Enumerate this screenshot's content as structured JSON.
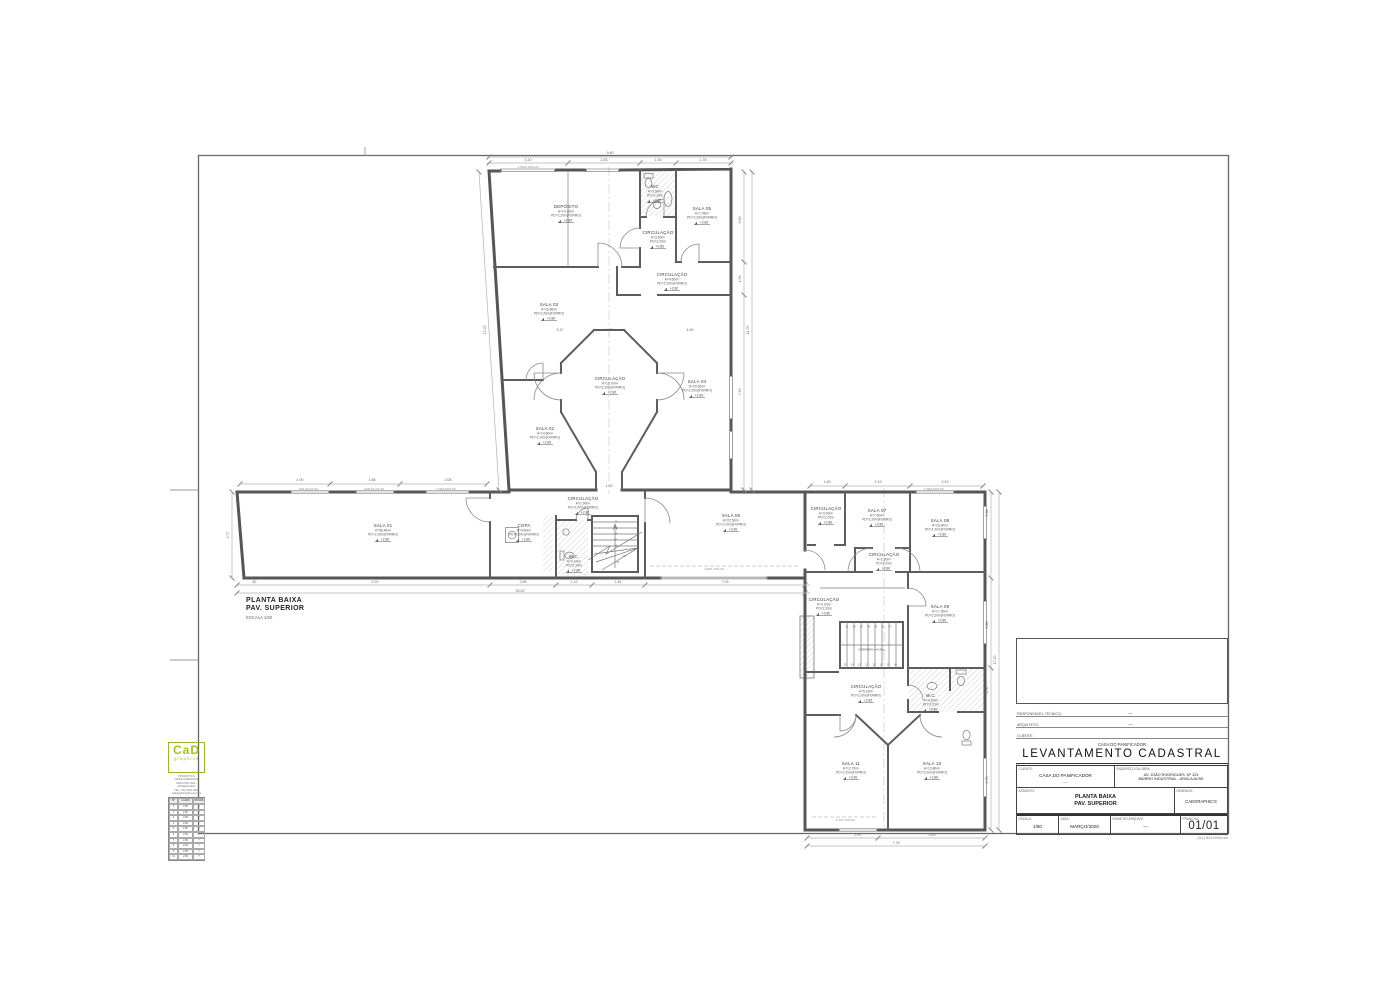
{
  "sheet": {
    "header": {
      "project_small": "CASA DO PANIFICADOR",
      "title": "LEVANTAMENTO  CADASTRAL"
    },
    "signatures": [
      {
        "label": "RESPONSÁVEL TÉCNICO:",
        "value": "—"
      },
      {
        "label": "ARQUITETO:",
        "value": "—"
      },
      {
        "label": "CLIENTE:",
        "value": ""
      }
    ],
    "info": {
      "cliente_label": "CLIENTE:",
      "cliente_value": "CASA DO PANIFICADOR",
      "cliente_value2": "—",
      "endereco_label": "ENDEREÇO DA OBRA:",
      "endereco_line1": "AV. JOÃO RODRIGUES, Nº 123",
      "endereco_line2": "BAIRRO INDUSTRIAL - ARACAJU/SE",
      "assunto_label": "ASSUNTO:",
      "assunto_line1": "PLANTA BAIXA",
      "assunto_line2": "PAV. SUPERIOR",
      "desenho_label": "DESENHO:",
      "desenho_value": "CADGRAPHIC'S",
      "escala_label": "ESCALA:",
      "escala_value": "1/50",
      "data_label": "DATA:",
      "data_value": "MARÇO/2020",
      "arquivo_label": "NOME DO ARQUIVO:",
      "arquivo_value": "—",
      "prancha_label": "PRANCHA:",
      "prancha_value": "01/01"
    },
    "paper_size": "(A1) 841x594mm"
  },
  "logo": {
    "line1": "CaD",
    "line2": "graphics",
    "contact": [
      "PROJETOS E DETALHAMENTOS",
      "ARQUITETURA - ENGENHARIA",
      "TEL: (79) 0000-0000",
      "cadgraphics@email.com"
    ]
  },
  "margin_table": {
    "headers": [
      "Nº",
      "LAJES",
      "PESOS"
    ],
    "rows": [
      [
        "1",
        "2,80",
        "7"
      ],
      [
        "2",
        "2,80",
        "7"
      ],
      [
        "3",
        "2,80",
        "7"
      ],
      [
        "4",
        "2,80",
        "7"
      ],
      [
        "5",
        "2,80",
        "7"
      ],
      [
        "6",
        "2,80",
        "7"
      ],
      [
        "7",
        "2,80",
        "7"
      ],
      [
        "8",
        "2,80",
        "7"
      ],
      [
        "9",
        "2,80",
        "7"
      ],
      [
        "10",
        "2,80",
        "7"
      ]
    ]
  },
  "plan_title": {
    "line1": "PLANTA BAIXA",
    "line2": "PAV. SUPERIOR",
    "scale": "ESCALA 1/50"
  },
  "plan": {
    "rooms": [
      {
        "name": "DEPÓSITO",
        "area": "A=14.10m²",
        "pd": "PD=2.20m(FORRO)",
        "level": "+2.80",
        "x": 566,
        "y": 208
      },
      {
        "name": "WC",
        "area": "A=3.30m²",
        "pd": "PD=2.20m",
        "level": "+2.80",
        "x": 655,
        "y": 188
      },
      {
        "name": "SALA 05",
        "area": "A=7.05m²",
        "pd": "PD=2.20m(FORRO)",
        "level": "+2.80",
        "x": 702,
        "y": 210
      },
      {
        "name": "CIRCULAÇÃO",
        "area": "A=3.60m²",
        "pd": "PD=2.20m",
        "level": "+2.80",
        "x": 658,
        "y": 234
      },
      {
        "name": "CIRCULAÇÃO",
        "area": "A=4.60m²",
        "pd": "PD=2.20m(FORRO)",
        "level": "+2.80",
        "x": 672,
        "y": 276
      },
      {
        "name": "SALA 03",
        "area": "A=16.80m²",
        "pd": "PD=2.20m(FORRO)",
        "level": "+2.80",
        "x": 549,
        "y": 306
      },
      {
        "name": "SALA 02",
        "area": "A=14.60m²",
        "pd": "PD=2.20m(FORRO)",
        "level": "+2.80",
        "x": 545,
        "y": 430
      },
      {
        "name": "CIRCULAÇÃO",
        "area": "A=10.70m²",
        "pd": "PD=2.20m(FORRO)",
        "level": "+2.80",
        "x": 610,
        "y": 380
      },
      {
        "name": "SALA 04",
        "area": "A=20.60m²",
        "pd": "PD=2.20m(FORRO)",
        "level": "+2.80",
        "x": 697,
        "y": 383
      },
      {
        "name": "SALA 01",
        "area": "A=56.40m²",
        "pd": "PD=2.20m(FORRO)",
        "level": "+2.80",
        "x": 383,
        "y": 527
      },
      {
        "name": "COPA",
        "area": "A=4.60m²",
        "pd": "PD=2.20m(FORRO)",
        "level": "+2.80",
        "x": 524,
        "y": 527
      },
      {
        "name": "W.C.",
        "area": "A=3.10m²",
        "pd": "PD=2.20m",
        "level": "+2.80",
        "x": 574,
        "y": 558
      },
      {
        "name": "CIRCULAÇÃO",
        "area": "A=2.90m²",
        "pd": "PD=2.20m(FORRO)",
        "level": "+2.80",
        "x": 583,
        "y": 500
      },
      {
        "name": "SALA 06",
        "area": "A=22.50m²",
        "pd": "PD=2.20m(FORRO)",
        "level": "+2.80",
        "x": 731,
        "y": 517
      },
      {
        "name": "CIRCULAÇÃO",
        "area": "A=3.00m²",
        "pd": "PD=2.20m",
        "level": "+2.80",
        "x": 826,
        "y": 510
      },
      {
        "name": "SALA 07",
        "area": "A=7.50m²",
        "pd": "PD=2.20m(FORRO)",
        "level": "+2.80",
        "x": 877,
        "y": 512
      },
      {
        "name": "SALA 08",
        "area": "A=16.60m²",
        "pd": "PD=2.20m(FORRO)",
        "level": "+2.80",
        "x": 940,
        "y": 522
      },
      {
        "name": "CIRCULAÇÃO",
        "area": "A=2.80m²",
        "pd": "PD=2.20m",
        "level": "+2.80",
        "x": 884,
        "y": 556
      },
      {
        "name": "CIRCULAÇÃO",
        "area": "A=4.10m²",
        "pd": "PD=2.20m",
        "level": "+2.80",
        "x": 824,
        "y": 601
      },
      {
        "name": "SALA 09",
        "area": "A=17.30m²",
        "pd": "PD=2.20m(FORRO)",
        "level": "+2.80",
        "x": 940,
        "y": 608
      },
      {
        "name": "CIRCULAÇÃO",
        "area": "A=5.10m²",
        "pd": "PD=2.20m(FORRO)",
        "level": "+2.80",
        "x": 866,
        "y": 688
      },
      {
        "name": "W.C.",
        "area": "A=4.20m²",
        "pd": "PD=2.20m",
        "level": "+2.80",
        "x": 931,
        "y": 697
      },
      {
        "name": "SALA 11",
        "area": "A=12.70m²",
        "pd": "PD=2.20m(FORRO)",
        "level": "+2.80",
        "x": 851,
        "y": 765
      },
      {
        "name": "SALA 10",
        "area": "A=13.80m²",
        "pd": "PD=2.20m(FORRO)",
        "level": "+2.80",
        "x": 932,
        "y": 765
      }
    ],
    "dimensions": [
      {
        "t": "9.80",
        "x": 610,
        "y": 154
      },
      {
        "t": "3.20",
        "x": 528,
        "y": 161
      },
      {
        "t": "2.45",
        "x": 604,
        "y": 161
      },
      {
        "t": "1.30",
        "x": 658,
        "y": 161
      },
      {
        "t": "1.78",
        "x": 703,
        "y": 161
      },
      {
        "t": "3.60",
        "x": 741,
        "y": 220,
        "r": -90
      },
      {
        "t": "1.35",
        "x": 741,
        "y": 279,
        "r": -90
      },
      {
        "t": "7.45",
        "x": 741,
        "y": 392,
        "r": -90
      },
      {
        "t": "11.70",
        "x": 749,
        "y": 330,
        "r": -90
      },
      {
        "t": "12.25",
        "x": 486,
        "y": 330,
        "r": -86
      },
      {
        "t": "3.77",
        "x": 229,
        "y": 535,
        "r": -90
      },
      {
        "t": "4.90",
        "x": 300,
        "y": 481
      },
      {
        "t": "1.88",
        "x": 372,
        "y": 481
      },
      {
        "t": "2.05",
        "x": 448,
        "y": 481
      },
      {
        "t": "1.45",
        "x": 827,
        "y": 483
      },
      {
        "t": "2.15",
        "x": 878,
        "y": 483
      },
      {
        "t": "2.43",
        "x": 945,
        "y": 483
      },
      {
        "t": ".82",
        "x": 254,
        "y": 583
      },
      {
        "t": "9.22",
        "x": 375,
        "y": 583
      },
      {
        "t": "2.69",
        "x": 523,
        "y": 583
      },
      {
        "t": "1.12",
        "x": 574,
        "y": 583
      },
      {
        "t": "1.54",
        "x": 618,
        "y": 583
      },
      {
        "t": "7.03",
        "x": 725,
        "y": 583
      },
      {
        "t": "25.02",
        "x": 520,
        "y": 592
      },
      {
        "t": "0.98",
        "x": 988,
        "y": 513,
        "r": -90
      },
      {
        "t": "5.86",
        "x": 988,
        "y": 625,
        "r": -90
      },
      {
        "t": "1.56",
        "x": 988,
        "y": 690,
        "r": -90
      },
      {
        "t": "4.70",
        "x": 988,
        "y": 780,
        "r": -90
      },
      {
        "t": "17.20",
        "x": 996,
        "y": 660,
        "r": -90
      },
      {
        "t": "2.97",
        "x": 858,
        "y": 836
      },
      {
        "t": "3.43",
        "x": 932,
        "y": 836
      },
      {
        "t": "7.78",
        "x": 896,
        "y": 844
      },
      {
        "t": "2.47",
        "x": 560,
        "y": 331
      },
      {
        "t": "1.40",
        "x": 609,
        "y": 331
      },
      {
        "t": "4.40",
        "x": 690,
        "y": 331
      },
      {
        "t": "1.20",
        "x": 609,
        "y": 487
      }
    ],
    "annotations": [
      {
        "t": "1.50A1.00/1.20",
        "x": 528,
        "y": 168
      },
      {
        "t": "JAN.ALU/1.00",
        "x": 308,
        "y": 490
      },
      {
        "t": "JAN.ALU/1.00",
        "x": 374,
        "y": 490
      },
      {
        "t": "2.00A.60/1.50",
        "x": 446,
        "y": 490
      },
      {
        "t": "4.00A.70/1.10",
        "x": 714,
        "y": 570
      },
      {
        "t": "1.70A.70/1.50",
        "x": 845,
        "y": 821
      },
      {
        "t": "2.80A.60/1.50",
        "x": 934,
        "y": 490
      }
    ],
    "stairs": {
      "mid": [
        "10",
        "09",
        "08",
        "07",
        "06",
        "05",
        "04"
      ],
      "lower_top": [
        "01",
        "02",
        "03",
        "04",
        "05",
        "06",
        "07"
      ],
      "lower_bottom": [
        "15",
        "14",
        "13",
        "12",
        "11",
        "10",
        "09",
        "08"
      ],
      "lower_label": "CORRIMÃO h=0.90m"
    }
  }
}
